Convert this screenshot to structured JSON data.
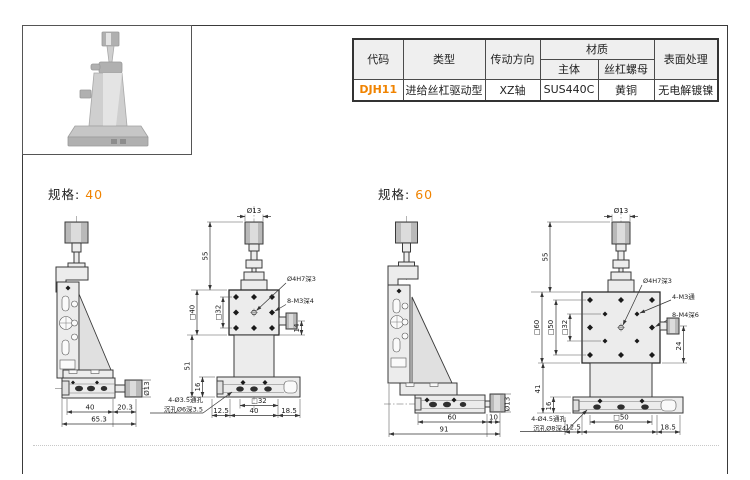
{
  "colors": {
    "accent": "#f08300",
    "table_header_bg": "#efefef",
    "line": "#333333"
  },
  "table": {
    "header_row1": [
      "代码",
      "类型",
      "传动方向",
      "材质",
      "表面处理"
    ],
    "header_row2": [
      "主体",
      "丝杠螺母"
    ],
    "rows": [
      [
        "DJH11",
        "进给丝杠驱动型",
        "XZ轴",
        "SUS440C",
        "黄铜",
        "无电解镀镍"
      ]
    ]
  },
  "spec40": {
    "label": "规格:",
    "size": "40",
    "side": {
      "knob_dia": "Ø13",
      "width_top": "40",
      "width_knob": "20.3",
      "width_total": "65.3"
    },
    "front": {
      "knob_dia": "Ø13",
      "height_top": "55",
      "center_hole": "Ø4H7深3",
      "corner_holes": "8-M3深4",
      "plate_size": "□40",
      "hole_square": "□32",
      "side_knob": "14",
      "body_height": "51",
      "base_height": "16",
      "base_hole_square": "□32",
      "base_left": "12.5",
      "base_width": "40",
      "base_right": "18.5",
      "note1": "4-Ø3.5通孔",
      "note2": "沉孔Ø6深3.5"
    }
  },
  "spec60": {
    "label": "规格:",
    "size": "60",
    "side": {
      "knob_dia": "Ø13",
      "width_top": "60",
      "width_knob": "10",
      "width_total": "91"
    },
    "front": {
      "knob_dia": "Ø13",
      "height_top": "55",
      "center_hole": "Ø4H7深3",
      "mid_holes": "4-M3通",
      "corner_holes": "8-M4深6",
      "plate_size": "□60",
      "hole_square": "□50",
      "inner_square": "□32",
      "side_knob": "24",
      "body_height": "41",
      "base_height": "16",
      "base_hole_square": "□50",
      "base_left": "12.5",
      "base_width": "60",
      "base_right": "18.5",
      "note1": "4-Ø4.5通孔",
      "note2": "沉孔Ø8深4"
    }
  }
}
